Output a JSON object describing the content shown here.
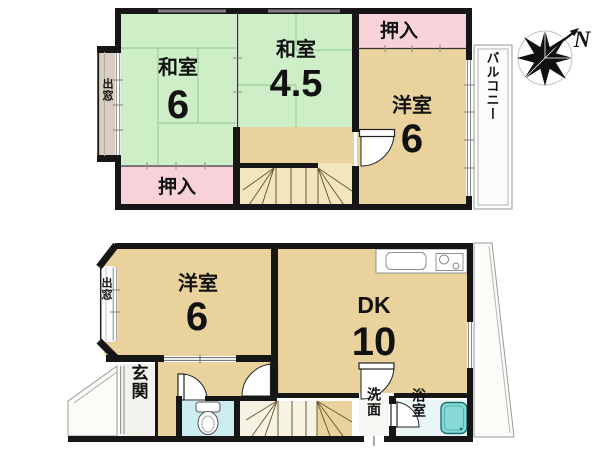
{
  "floorplan": {
    "colors": {
      "wall": "#161616",
      "tatami_green": "#cdeec6",
      "tatami_line": "#99cf9d",
      "wood_tan": "#e9d29c",
      "wood_light": "#f2e6bf",
      "closet_pink": "#f7d3d9",
      "bay_gray": "#d6cec0",
      "toilet_floor": "#cdecf2",
      "bath_floor": "#e9f6f5",
      "bathtub_teal": "#86d9d7",
      "outdoor_white": "#fbfbf8"
    },
    "floor2": {
      "washitsu6": {
        "label": "和室",
        "size": "6"
      },
      "washitsu45": {
        "label": "和室",
        "size": "4.5"
      },
      "closet_top": {
        "label": "押入"
      },
      "closet_bottom": {
        "label": "押入"
      },
      "youshitsu6": {
        "label": "洋室",
        "size": "6"
      },
      "balcony": {
        "label": "バルコニー"
      },
      "bay_window": {
        "label": "出窓"
      }
    },
    "floor1": {
      "youshitsu6": {
        "label": "洋室",
        "size": "6"
      },
      "dk": {
        "label": "DK",
        "size": "10"
      },
      "entrance": {
        "label": "玄関"
      },
      "washroom": {
        "label": "洗面"
      },
      "bathroom": {
        "label": "浴室"
      },
      "bay_window": {
        "label": "出窓"
      }
    },
    "compass": {
      "north": "N"
    }
  }
}
